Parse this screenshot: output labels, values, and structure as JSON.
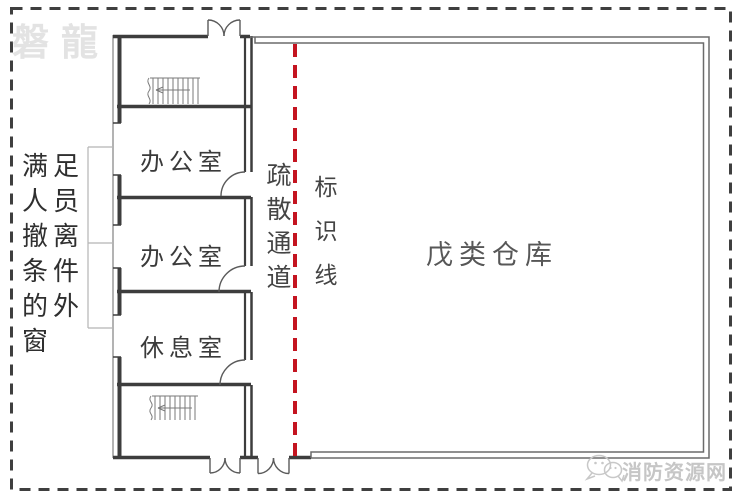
{
  "watermarks": {
    "top_left": "磐龍",
    "bottom_right": "消防资源网"
  },
  "floor_plan": {
    "rooms": [
      {
        "id": "office-1",
        "label": "办公室"
      },
      {
        "id": "office-2",
        "label": "办公室"
      },
      {
        "id": "rest-room",
        "label": "休息室"
      },
      {
        "id": "warehouse",
        "label": "戊类仓库"
      }
    ],
    "annotations": [
      {
        "id": "window-note",
        "label": "满足人员撤离条件的外窗"
      },
      {
        "id": "evacuation-corridor",
        "label": "疏散通道"
      },
      {
        "id": "marking-line",
        "label": "标识线"
      }
    ],
    "icons": {
      "stairwells": "stairs-icon",
      "bottom_watermark": "chat-bubbles-icon"
    },
    "colors": {
      "marking_line_red": "#c41420",
      "wall_dark": "#3d3d3d",
      "wall_light": "#6b6b6b",
      "watermark_light_gray": "#e3e3e3",
      "watermark_gray": "#c6c6c6"
    }
  }
}
